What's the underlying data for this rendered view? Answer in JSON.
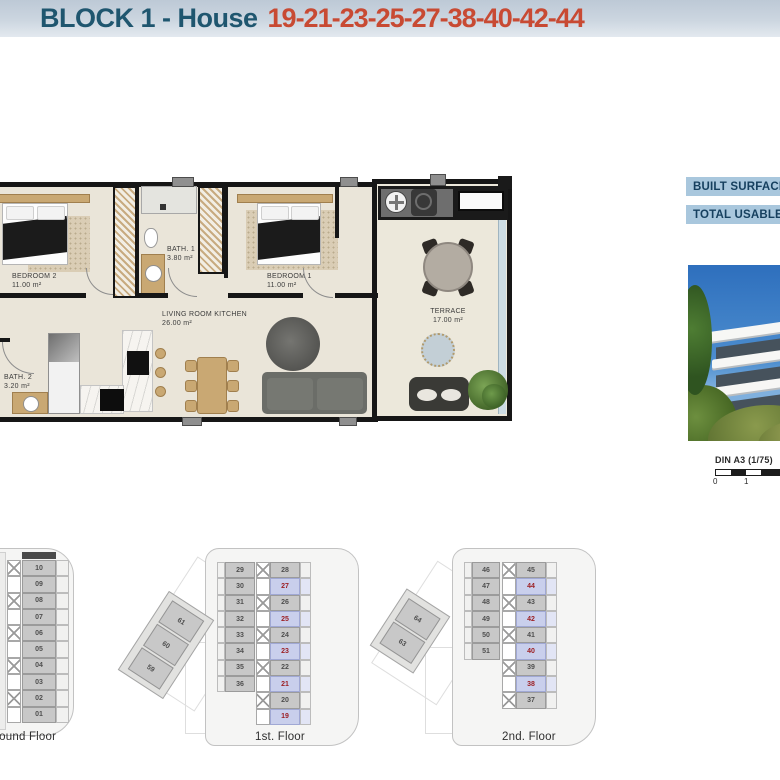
{
  "header": {
    "title_prefix": "BLOCK 1 - House",
    "title_numbers": "19-21-23-25-27-38-40-42-44"
  },
  "main_plan": {
    "bedroom2": {
      "name": "BEDROOM 2",
      "area": "11.00 m²"
    },
    "bath1": {
      "name": "BATH. 1",
      "area": "3.80 m²"
    },
    "bedroom1": {
      "name": "BEDROOM 1",
      "area": "11.00 m²"
    },
    "living": {
      "name": "LIVING ROOM KITCHEN",
      "area": "26.00 m²"
    },
    "bath2": {
      "name": "BATH. 2",
      "area": "3.20 m²"
    },
    "terrace": {
      "name": "TERRACE",
      "area": "17.00 m²"
    }
  },
  "side_panel": {
    "built_surface_label": "BUILT SURFACE",
    "total_usable_label": "TOTAL USABLE",
    "scale_title": "DIN A3 (1/75)",
    "scale_tick_0": "0",
    "scale_tick_1": "1"
  },
  "floors": {
    "ground": {
      "label": "Ground Floor",
      "units": [
        "10",
        "09",
        "08",
        "07",
        "06",
        "05",
        "04",
        "03",
        "02",
        "01"
      ]
    },
    "first": {
      "label": "1st. Floor",
      "diagonal_units": [
        "61",
        "60",
        "59"
      ],
      "left_units": [
        "29",
        "30",
        "31",
        "32",
        "33",
        "34",
        "35",
        "36"
      ],
      "right_units": [
        {
          "n": "28",
          "hl": false
        },
        {
          "n": "27",
          "hl": true
        },
        {
          "n": "26",
          "hl": false
        },
        {
          "n": "25",
          "hl": true
        },
        {
          "n": "24",
          "hl": false
        },
        {
          "n": "23",
          "hl": true
        },
        {
          "n": "22",
          "hl": false
        },
        {
          "n": "21",
          "hl": true
        },
        {
          "n": "20",
          "hl": false
        },
        {
          "n": "19",
          "hl": true
        }
      ]
    },
    "second": {
      "label": "2nd. Floor",
      "diagonal_units": [
        "64",
        "63"
      ],
      "left_units": [
        "46",
        "47",
        "48",
        "49",
        "50",
        "51"
      ],
      "right_units": [
        {
          "n": "45",
          "hl": false
        },
        {
          "n": "44",
          "hl": true
        },
        {
          "n": "43",
          "hl": false
        },
        {
          "n": "42",
          "hl": true
        },
        {
          "n": "41",
          "hl": false
        },
        {
          "n": "40",
          "hl": true
        },
        {
          "n": "39",
          "hl": false
        },
        {
          "n": "38",
          "hl": true
        },
        {
          "n": "37",
          "hl": false
        }
      ]
    }
  },
  "colors": {
    "title_prefix": "#1f566f",
    "title_numbers": "#c84a33",
    "highlight_unit_bg": "#c9cfec",
    "highlight_unit_text": "#9c2024",
    "label_bar_bg": "#a9c7dd",
    "label_bar_text": "#16405f"
  }
}
